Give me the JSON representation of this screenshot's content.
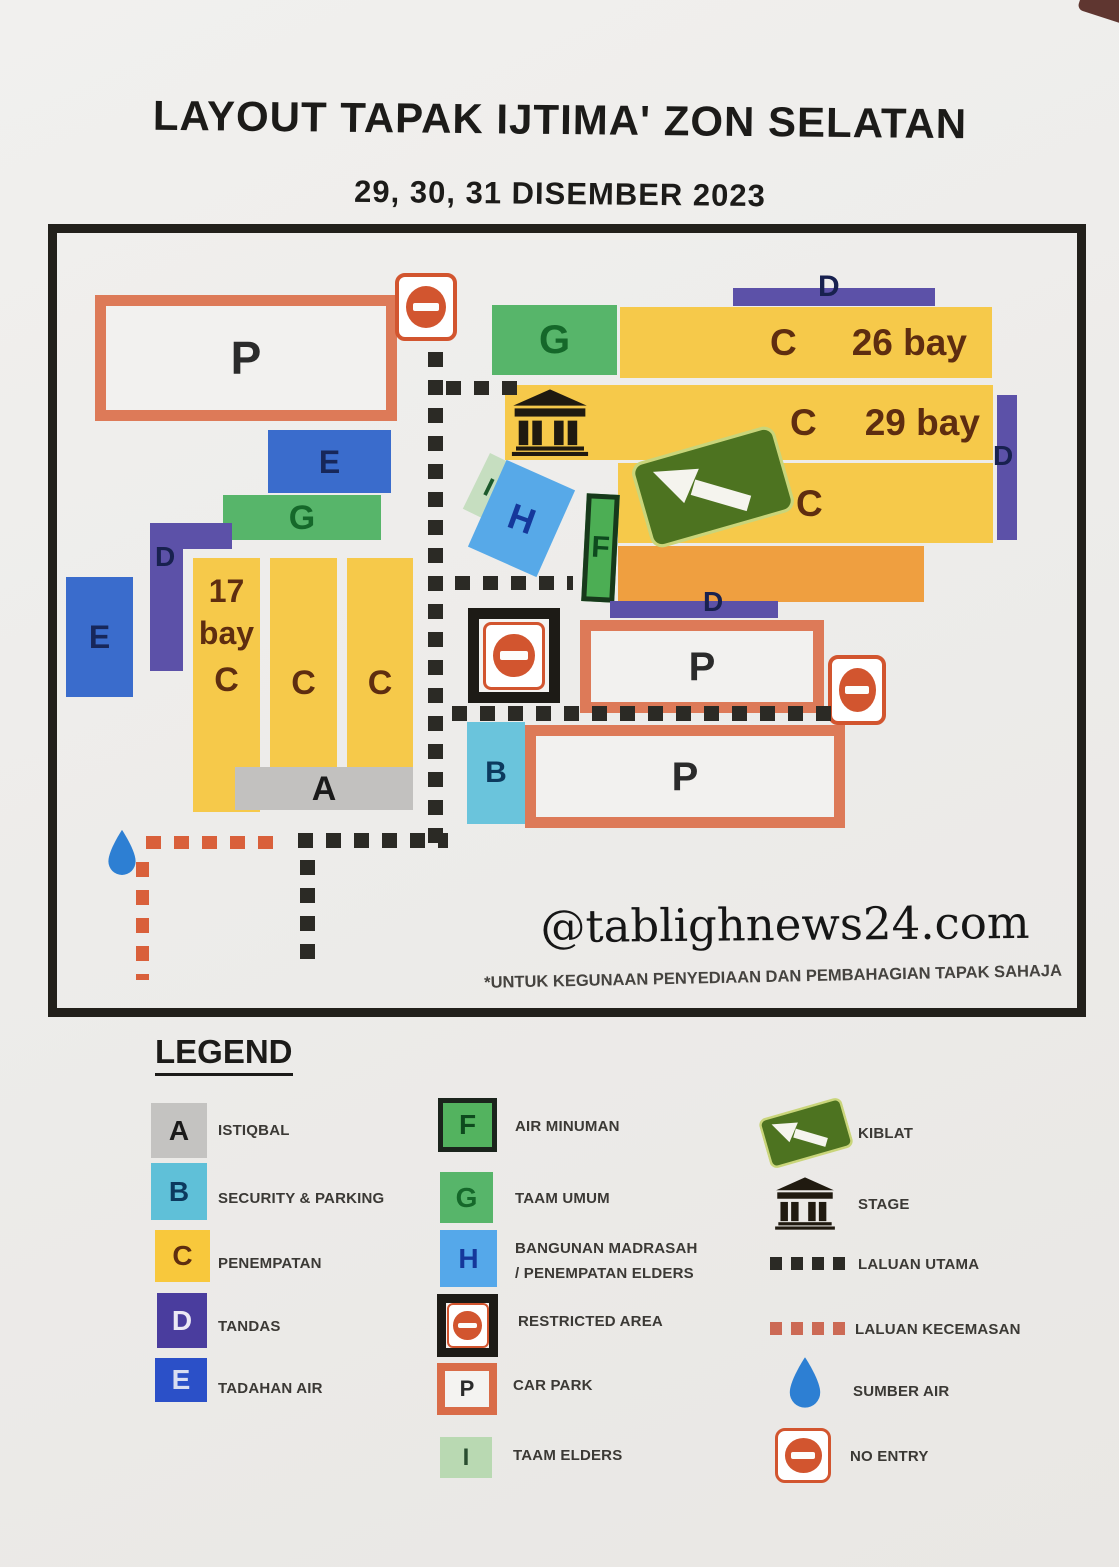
{
  "page": {
    "title": "LAYOUT TAPAK IJTIMA' ZON SELATAN",
    "subtitle": "29, 30, 31 DISEMBER 2023",
    "watermark": "@tablighnews24.com",
    "footnote": "*UNTUK KEGUNAAN PENYEDIAAN DAN PEMBAHAGIAN TAPAK SAHAJA"
  },
  "map": {
    "parking_top": "P",
    "taam_top": "G",
    "band1": {
      "letter": "C",
      "bay": "26 bay"
    },
    "band2": {
      "letter": "C",
      "bay": "29 bay"
    },
    "band3": {
      "letter": "C"
    },
    "d_top": "D",
    "d_right": "D",
    "d_mid": "D",
    "d_left": "D",
    "e_upper": "E",
    "e_left": "E",
    "g_left": "G",
    "col1": {
      "line1": "17",
      "line2": "bay",
      "letter": "C"
    },
    "col2": "C",
    "col3": "C",
    "a_bar": "A",
    "i_block": "I",
    "h_block": "H",
    "f_block": "F",
    "b_block": "B",
    "parking_mid": "P",
    "parking_bottom": "P"
  },
  "legend": {
    "title": "LEGEND",
    "col1": [
      {
        "key": "A",
        "label": "ISTIQBAL",
        "color": "#c4c3c1"
      },
      {
        "key": "B",
        "label": "SECURITY & PARKING",
        "color": "#5fc0d8"
      },
      {
        "key": "C",
        "label": "PENEMPATAN",
        "color": "#f8c83c"
      },
      {
        "key": "D",
        "label": "TANDAS",
        "color": "#4a3d9e"
      },
      {
        "key": "E",
        "label": "TADAHAN AIR",
        "color": "#2b50c8"
      }
    ],
    "col2": [
      {
        "key": "F",
        "label": "AIR MINUMAN",
        "color": "#53b35f"
      },
      {
        "key": "G",
        "label": "TAAM UMUM",
        "color": "#57b56a"
      },
      {
        "key": "H",
        "label": "BANGUNAN MADRASAH",
        "label2": "/ PENEMPATAN ELDERS",
        "color": "#55a8ea"
      },
      {
        "key": "",
        "label": "RESTRICTED AREA",
        "color": "#d2552f"
      },
      {
        "key": "P",
        "label": "CAR PARK",
        "color": "#dd7a58"
      },
      {
        "key": "I",
        "label": "TAAM ELDERS",
        "color": "#b9d9b2"
      }
    ],
    "col3": [
      {
        "label": "KIBLAT",
        "color": "#4d7320"
      },
      {
        "label": "STAGE",
        "color": "#201a10"
      },
      {
        "label": "LALUAN UTAMA",
        "color": "#2b2a25"
      },
      {
        "label": "LALUAN KECEMASAN",
        "color": "#d9603b"
      },
      {
        "label": "SUMBER AIR",
        "color": "#2d7fd3"
      },
      {
        "label": "NO ENTRY",
        "color": "#d2552f"
      }
    ]
  },
  "colors": {
    "zone_yellow": "#f6c94a",
    "zone_orange": "#ef9f40",
    "zone_purple": "#5c51a8",
    "zone_blue": "#3a6ccc",
    "zone_teal": "#6ac4dc",
    "zone_lightblue": "#57a9e8",
    "zone_green": "#57b56a",
    "zone_lightgreen": "#c6dec0",
    "zone_gray": "#c2c1bf",
    "carpark_border": "#dd7a58",
    "no_entry": "#d2552f",
    "route_main": "#2b2a25",
    "route_emergency": "#d9603b"
  }
}
